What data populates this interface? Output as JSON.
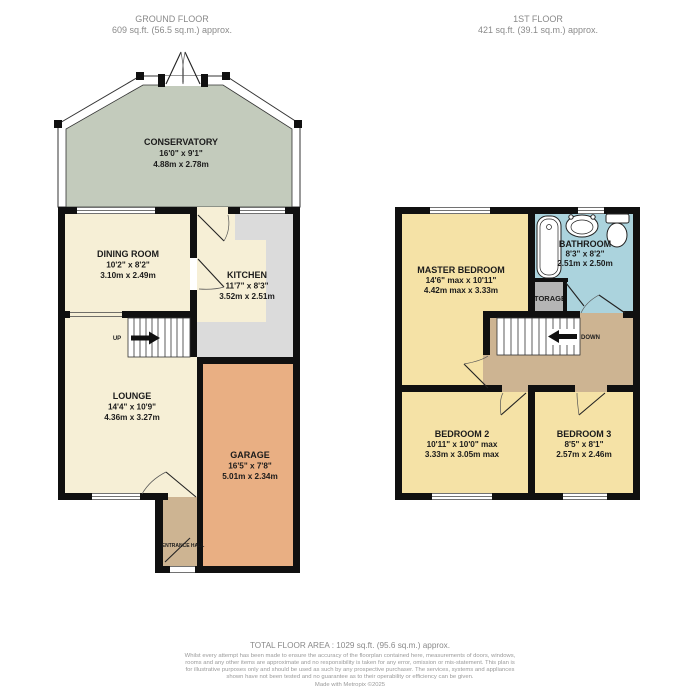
{
  "colors": {
    "wall": "#101010",
    "cream": "#f6efd6",
    "counter": "#dbdbdb",
    "conservatory": "#c3cbbc",
    "garage": "#e9af83",
    "hall": "#cdb492",
    "bedroom": "#f5e2a6",
    "bathroom": "#abd3dd",
    "storage": "#b5b5b5"
  },
  "header": {
    "ground": {
      "title": "GROUND FLOOR",
      "area": "609 sq.ft. (56.5 sq.m.) approx."
    },
    "first": {
      "title": "1ST FLOOR",
      "area": "421 sq.ft. (39.1 sq.m.) approx."
    }
  },
  "ground_floor": {
    "conservatory": {
      "name": "CONSERVATORY",
      "imperial": "16'0\" x 9'1\"",
      "metric": "4.88m x 2.78m"
    },
    "dining_room": {
      "name": "DINING ROOM",
      "imperial": "10'2\" x 8'2\"",
      "metric": "3.10m x 2.49m"
    },
    "kitchen": {
      "name": "KITCHEN",
      "imperial": "11'7\" x 8'3\"",
      "metric": "3.52m x 2.51m"
    },
    "lounge": {
      "name": "LOUNGE",
      "imperial": "14'4\" x 10'9\"",
      "metric": "4.36m x 3.27m"
    },
    "garage": {
      "name": "GARAGE",
      "imperial": "16'5\" x 7'8\"",
      "metric": "5.01m x 2.34m"
    },
    "entrance_hall": {
      "name": "ENTRANCE HALL"
    },
    "stairs_label": "UP"
  },
  "first_floor": {
    "master_bedroom": {
      "name": "MASTER BEDROOM",
      "imperial": "14'6\" max x 10'11\"",
      "metric": "4.42m max x 3.33m"
    },
    "bathroom": {
      "name": "BATHROOM",
      "imperial": "8'3\" x 8'2\"",
      "metric": "2.51m x 2.50m"
    },
    "storage": {
      "name": "STORAGE"
    },
    "bedroom_2": {
      "name": "BEDROOM 2",
      "imperial": "10'11\" x 10'0\" max",
      "metric": "3.33m x 3.05m max"
    },
    "bedroom_3": {
      "name": "BEDROOM 3",
      "imperial": "8'5\" x 8'1\"",
      "metric": "2.57m x 2.46m"
    },
    "stairs_label": "DOWN"
  },
  "footer": {
    "total_area": "TOTAL FLOOR AREA : 1029 sq.ft. (95.6 sq.m.) approx.",
    "disclaimer": "Whilst every attempt has been made to ensure the accuracy of the floorplan contained here, measurements of doors, windows, rooms and any other items are approximate and no responsibility is taken for any error, omission or mis-statement. This plan is for illustrative purposes only and should be used as such by any prospective purchaser. The services, systems and appliances shown have not been tested and no guarantee as to their operability or efficiency can be given.",
    "credit": "Made with Metropix ©2025"
  }
}
